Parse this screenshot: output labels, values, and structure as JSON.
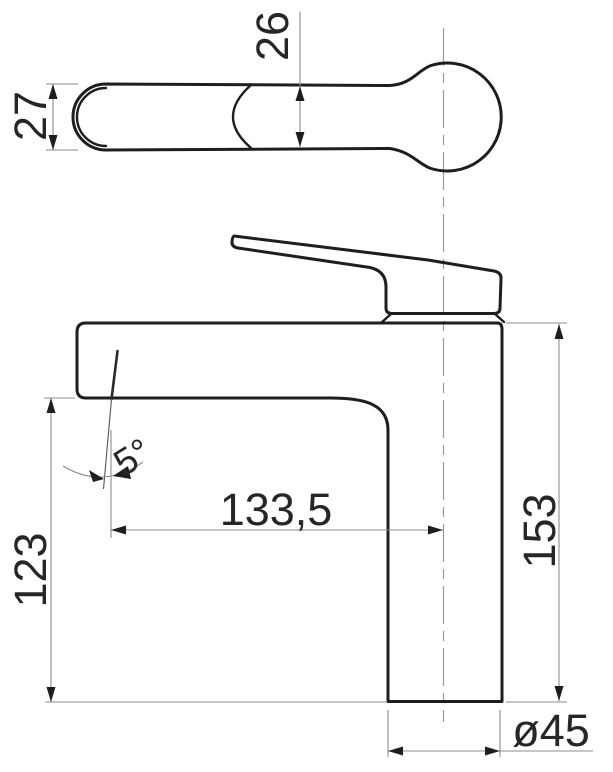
{
  "colors": {
    "background": "#ffffff",
    "outline": "#1e1e1e",
    "dimension_lines": "#8c8c8c",
    "dimension_text": "#262626"
  },
  "top_view": {
    "handle_end_width": "27",
    "handle_neck_width": "26"
  },
  "side_view": {
    "aerator_angle": "5°",
    "spout_reach": "133,5",
    "spout_outlet_height": "123",
    "overall_height": "153",
    "base_diameter": "ø45"
  }
}
